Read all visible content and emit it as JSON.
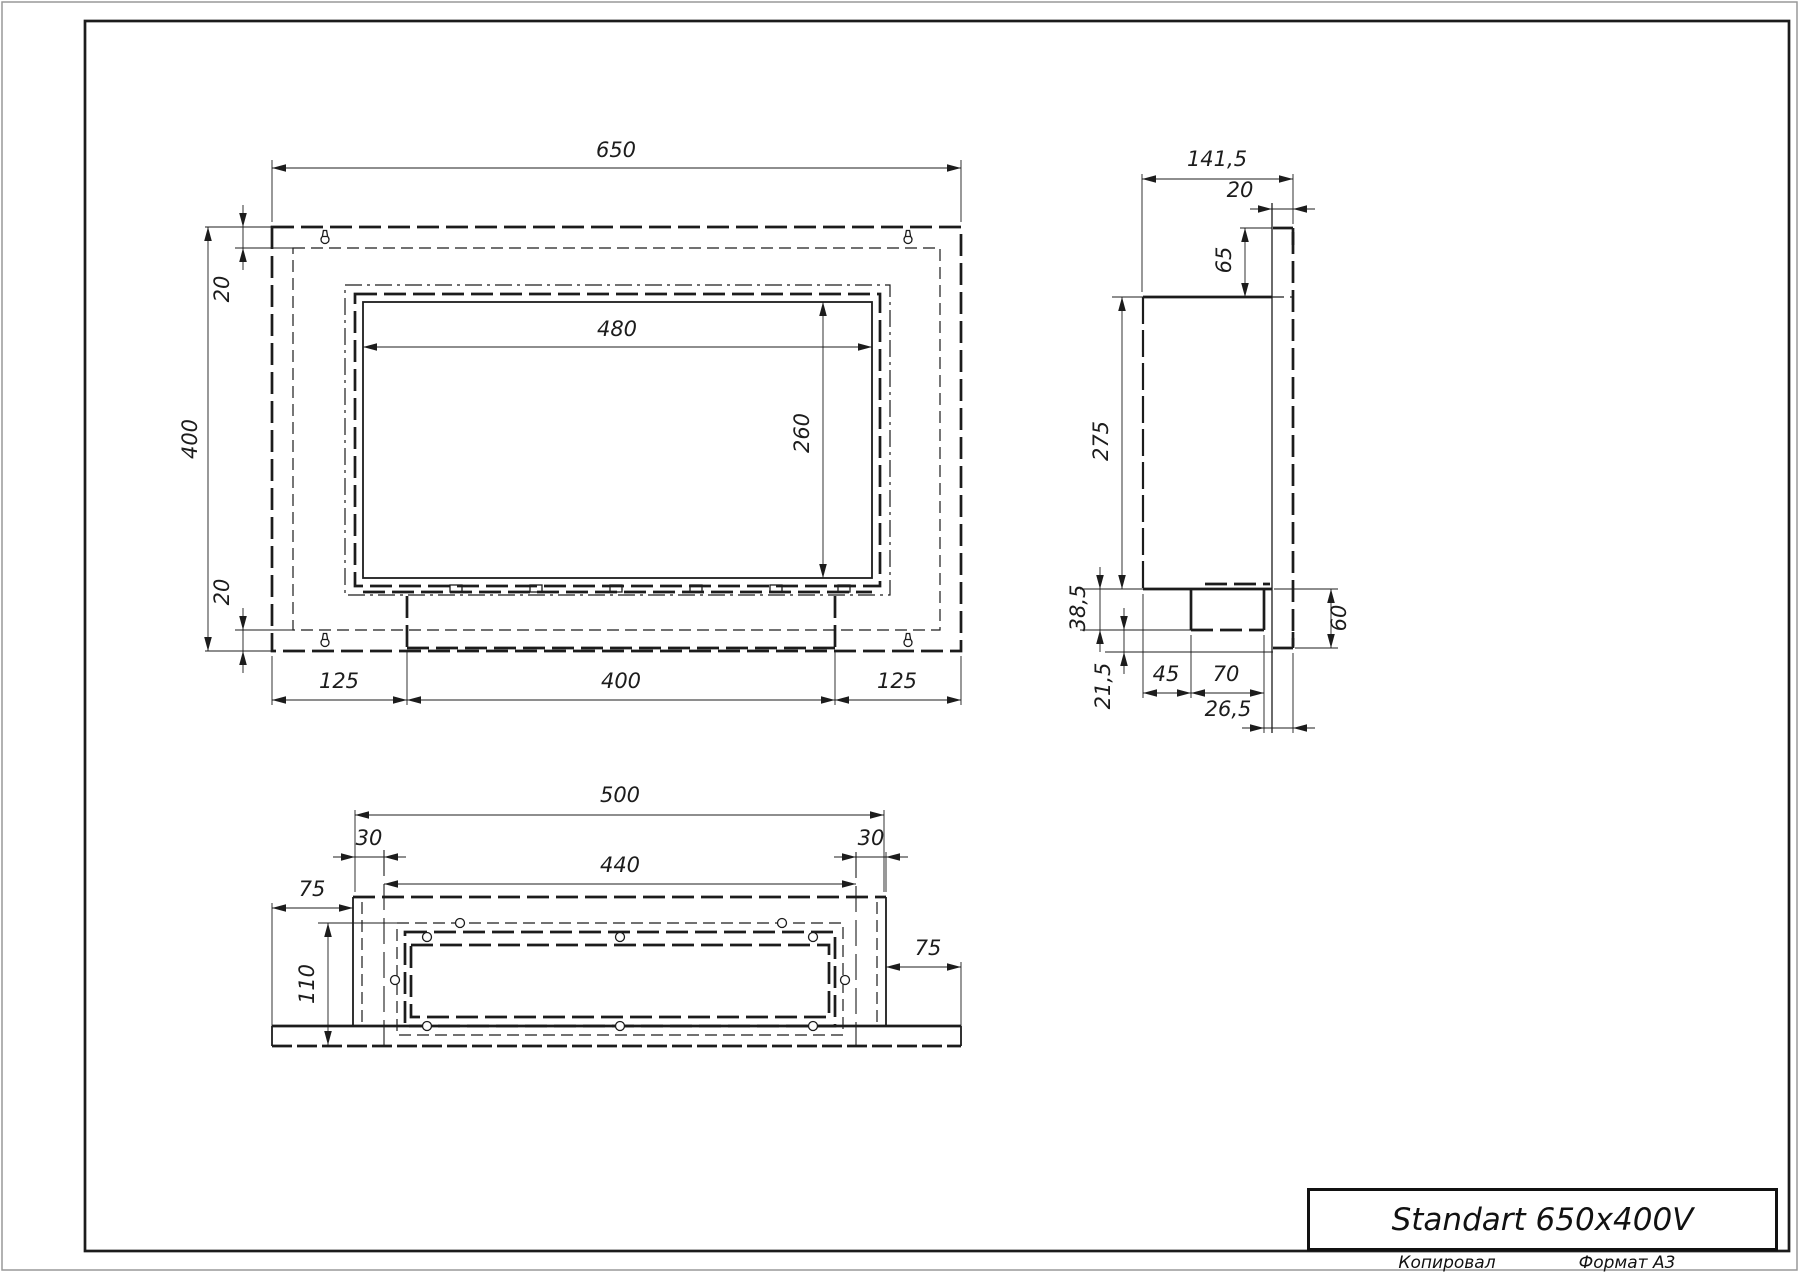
{
  "title_block": {
    "title": "Standart 650x400V",
    "footer_left": "Копировал",
    "footer_right": "Формат А3"
  },
  "drawing": {
    "width": 1800,
    "height": 1273,
    "ink": "#1c1c1c",
    "border_color": "#999999",
    "sheet": {
      "outer": [
        2,
        2,
        1795,
        1268
      ],
      "frame": [
        85,
        21,
        1704,
        1230
      ]
    },
    "title_box": {
      "x": 1307,
      "y": 1188,
      "w": 471,
      "h": 63
    },
    "footer_left_pos": {
      "x": 1447,
      "y": 1253
    },
    "footer_right_pos": {
      "x": 1627,
      "y": 1253
    },
    "views": {
      "front": {
        "rects": [
          [
            272,
            227,
            689,
            424,
            "dk"
          ],
          [
            293,
            248,
            647,
            382,
            "dt"
          ],
          [
            345,
            285,
            545,
            310,
            "dd"
          ],
          [
            355,
            294,
            525,
            292,
            "dk"
          ],
          [
            363,
            302,
            509,
            276,
            "lm"
          ]
        ],
        "lines": [
          [
            363,
            592,
            872,
            592,
            "dk"
          ],
          [
            407,
            596,
            407,
            648,
            "dk"
          ],
          [
            835,
            596,
            835,
            648,
            "dk"
          ],
          [
            407,
            648,
            835,
            648,
            "dk"
          ]
        ],
        "tabs": [
          [
            450,
            585
          ],
          [
            530,
            585
          ],
          [
            610,
            585
          ],
          [
            690,
            585
          ],
          [
            770,
            585
          ],
          [
            838,
            585
          ]
        ],
        "keyholes": [
          [
            325,
            238
          ],
          [
            908,
            238
          ],
          [
            325,
            641
          ],
          [
            908,
            641
          ]
        ],
        "circles": [],
        "exts": [
          [
            272,
            222,
            272,
            160
          ],
          [
            961,
            222,
            961,
            160
          ],
          [
            205,
            227,
            272,
            227
          ],
          [
            205,
            651,
            272,
            651
          ],
          [
            235,
            248,
            293,
            248
          ],
          [
            235,
            630,
            293,
            630
          ],
          [
            272,
            656,
            272,
            705
          ],
          [
            407,
            652,
            407,
            705
          ],
          [
            835,
            652,
            835,
            705
          ],
          [
            961,
            656,
            961,
            705
          ]
        ],
        "dims": [
          {
            "o": "h",
            "at": 168,
            "a": 272,
            "b": 961,
            "t": "650",
            "lx": 616,
            "ly": 157,
            "ar": "in"
          },
          {
            "o": "v",
            "at": 208,
            "a": 227,
            "b": 651,
            "t": "400",
            "lx": 197,
            "ly": 439,
            "ar": "in",
            "rot": 1
          },
          {
            "o": "v",
            "at": 243,
            "a": 227,
            "b": 248,
            "t": "20",
            "lx": 229,
            "ly": 289,
            "ar": "out",
            "rot": 1
          },
          {
            "o": "v",
            "at": 243,
            "a": 630,
            "b": 651,
            "t": "20",
            "lx": 229,
            "ly": 592,
            "ar": "out",
            "rot": 1
          },
          {
            "o": "h",
            "at": 347,
            "a": 363,
            "b": 872,
            "t": "480",
            "lx": 617,
            "ly": 336,
            "ar": "in"
          },
          {
            "o": "v",
            "at": 823,
            "a": 302,
            "b": 578,
            "t": "260",
            "lx": 809,
            "ly": 433,
            "ar": "in",
            "rot": 1
          },
          {
            "o": "h",
            "at": 700,
            "a": 272,
            "b": 407,
            "t": "125",
            "lx": 339,
            "ly": 688,
            "ar": "in"
          },
          {
            "o": "h",
            "at": 700,
            "a": 407,
            "b": 835,
            "t": "400",
            "lx": 621,
            "ly": 688,
            "ar": "in"
          },
          {
            "o": "h",
            "at": 700,
            "a": 835,
            "b": 961,
            "t": "125",
            "lx": 897,
            "ly": 688,
            "ar": "in"
          }
        ]
      },
      "side": {
        "rects": [],
        "lines": [
          [
            1143,
            297,
            1272,
            297,
            "lk"
          ],
          [
            1143,
            297,
            1143,
            589,
            "dk2"
          ],
          [
            1143,
            589,
            1272,
            589,
            "lk"
          ],
          [
            1205,
            584,
            1270,
            584,
            "dk"
          ],
          [
            1191,
            589,
            1191,
            630,
            "lk"
          ],
          [
            1264,
            589,
            1264,
            630,
            "lk"
          ],
          [
            1191,
            630,
            1264,
            630,
            "dk"
          ],
          [
            1272,
            203,
            1272,
            733,
            "lt"
          ],
          [
            1293,
            232,
            1293,
            646,
            "dk"
          ],
          [
            1273,
            228,
            1293,
            228,
            "lk"
          ],
          [
            1293,
            228,
            1293,
            245,
            "lk"
          ],
          [
            1273,
            648,
            1293,
            648,
            "lk"
          ],
          [
            1293,
            632,
            1293,
            648,
            "lk"
          ],
          [
            1272,
            297,
            1293,
            297,
            "dt"
          ]
        ],
        "tabs": [],
        "keyholes": [],
        "circles": [],
        "exts": [
          [
            1142,
            292,
            1142,
            174
          ],
          [
            1293,
            224,
            1293,
            174
          ],
          [
            1240,
            228,
            1272,
            228
          ],
          [
            1112,
            297,
            1143,
            297
          ],
          [
            1080,
            589,
            1143,
            589
          ],
          [
            1080,
            630,
            1191,
            630
          ],
          [
            1105,
            652,
            1273,
            652
          ],
          [
            1143,
            594,
            1143,
            698
          ],
          [
            1191,
            635,
            1191,
            698
          ],
          [
            1264,
            635,
            1264,
            733
          ],
          [
            1293,
            653,
            1293,
            733
          ],
          [
            1274,
            589,
            1338,
            589
          ],
          [
            1295,
            648,
            1338,
            648
          ]
        ],
        "dims": [
          {
            "o": "h",
            "at": 179,
            "a": 1142,
            "b": 1293,
            "t": "141,5",
            "lx": 1217,
            "ly": 166,
            "ar": "in"
          },
          {
            "o": "h",
            "at": 209,
            "a": 1272,
            "b": 1293,
            "t": "20",
            "lx": 1240,
            "ly": 197,
            "ar": "out"
          },
          {
            "o": "v",
            "at": 1245,
            "a": 228,
            "b": 297,
            "t": "65",
            "lx": 1231,
            "ly": 260,
            "ar": "in",
            "rot": 1
          },
          {
            "o": "v",
            "at": 1122,
            "a": 297,
            "b": 589,
            "t": "275",
            "lx": 1108,
            "ly": 441,
            "ar": "in",
            "rot": 1
          },
          {
            "o": "v",
            "at": 1100,
            "a": 589,
            "b": 630,
            "t": "38,5",
            "lx": 1085,
            "ly": 608,
            "ar": "out",
            "rot": 1
          },
          {
            "o": "v",
            "at": 1124,
            "a": 630,
            "b": 652,
            "t": "21,5",
            "lx": 1110,
            "ly": 686,
            "ar": "out",
            "rot": 1
          },
          {
            "o": "h",
            "at": 693,
            "a": 1143,
            "b": 1191,
            "t": "45",
            "lx": 1166,
            "ly": 681,
            "ar": "in"
          },
          {
            "o": "h",
            "at": 693,
            "a": 1191,
            "b": 1264,
            "t": "70",
            "lx": 1226,
            "ly": 681,
            "ar": "in"
          },
          {
            "o": "h",
            "at": 728,
            "a": 1264,
            "b": 1293,
            "t": "26,5",
            "lx": 1228,
            "ly": 716,
            "ar": "out"
          },
          {
            "o": "v",
            "at": 1331,
            "a": 589,
            "b": 648,
            "t": "60",
            "lx": 1346,
            "ly": 618,
            "ar": "in",
            "rot": 1
          }
        ]
      },
      "bottom": {
        "rects": [
          [
            397,
            923,
            446,
            112,
            "dt"
          ],
          [
            405,
            932,
            430,
            94,
            "dk"
          ],
          [
            411,
            945,
            418,
            72,
            "dk"
          ]
        ],
        "lines": [
          [
            353,
            897,
            886,
            897,
            "dk"
          ],
          [
            353,
            897,
            353,
            1026,
            "lm"
          ],
          [
            886,
            897,
            886,
            1026,
            "lm"
          ],
          [
            362,
            902,
            362,
            1026,
            "dt"
          ],
          [
            877,
            902,
            877,
            1026,
            "dt"
          ],
          [
            272,
            1026,
            961,
            1026,
            "lk"
          ],
          [
            272,
            1046,
            961,
            1046,
            "dk3"
          ],
          [
            272,
            1026,
            272,
            1046,
            "lm"
          ],
          [
            961,
            1026,
            961,
            1046,
            "lm"
          ],
          [
            384,
            850,
            384,
            1046,
            "dd2"
          ],
          [
            856,
            852,
            856,
            1046,
            "dd2"
          ]
        ],
        "tabs": [],
        "keyholes": [],
        "circles": [
          [
            460,
            923
          ],
          [
            782,
            923
          ],
          [
            427,
            937
          ],
          [
            620,
            937
          ],
          [
            813,
            937
          ],
          [
            395,
            980
          ],
          [
            845,
            980
          ],
          [
            427,
            1026
          ],
          [
            620,
            1026
          ],
          [
            813,
            1026
          ]
        ],
        "exts": [
          [
            355,
            892,
            355,
            810
          ],
          [
            884,
            892,
            884,
            810
          ],
          [
            886,
            892,
            886,
            852
          ],
          [
            272,
            903,
            272,
            1026
          ],
          [
            961,
            962,
            961,
            1026
          ],
          [
            318,
            923,
            397,
            923
          ]
        ],
        "dims": [
          {
            "o": "h",
            "at": 815,
            "a": 355,
            "b": 884,
            "t": "500",
            "lx": 620,
            "ly": 802,
            "ar": "in"
          },
          {
            "o": "h",
            "at": 857,
            "a": 355,
            "b": 384,
            "t": "30",
            "lx": 369,
            "ly": 845,
            "ar": "out"
          },
          {
            "o": "h",
            "at": 857,
            "a": 856,
            "b": 886,
            "t": "30",
            "lx": 871,
            "ly": 845,
            "ar": "out"
          },
          {
            "o": "h",
            "at": 884,
            "a": 384,
            "b": 856,
            "t": "440",
            "lx": 620,
            "ly": 872,
            "ar": "in"
          },
          {
            "o": "h",
            "at": 908,
            "a": 272,
            "b": 353,
            "t": "75",
            "lx": 312,
            "ly": 896,
            "ar": "in"
          },
          {
            "o": "h",
            "at": 967,
            "a": 886,
            "b": 961,
            "t": "75",
            "lx": 928,
            "ly": 955,
            "ar": "in"
          },
          {
            "o": "v",
            "at": 328,
            "a": 923,
            "b": 1045,
            "t": "110",
            "lx": 314,
            "ly": 984,
            "ar": "in",
            "rot": 1
          }
        ]
      }
    }
  }
}
